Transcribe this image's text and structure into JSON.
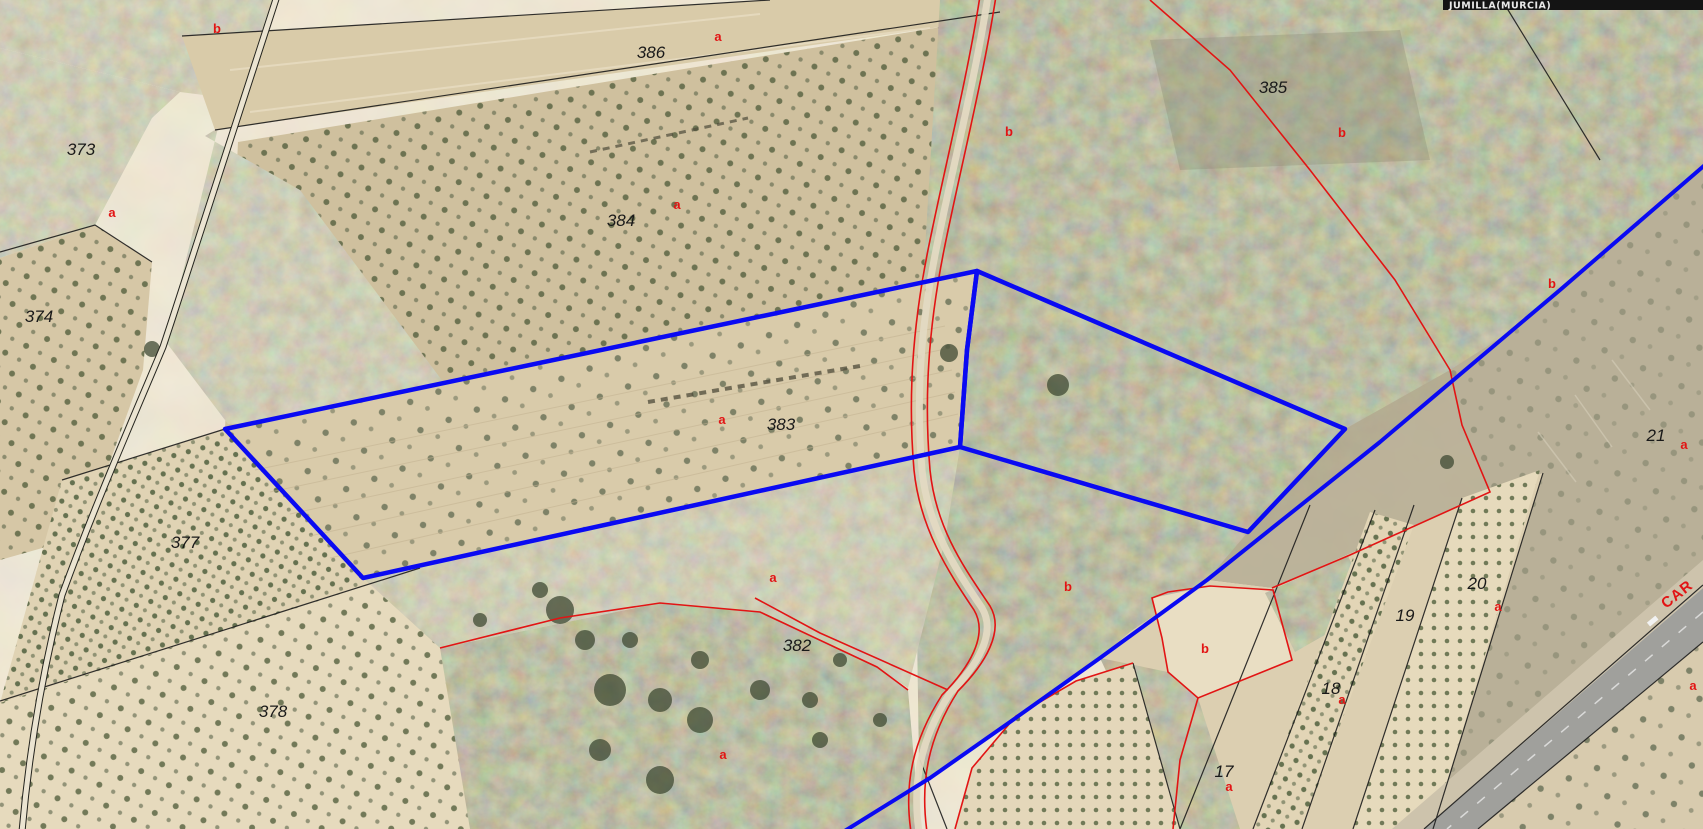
{
  "map": {
    "municipality_bar": {
      "label": "JUMILLA(MURCIA)"
    },
    "road_label": {
      "text": "CAR",
      "angle": -38
    },
    "colors": {
      "highlight_blue": "#0a0af2",
      "boundary_red": "#e21414",
      "boundary_black": "#1c1c1c",
      "bar_background": "#141414",
      "bar_text": "#e8e8e8"
    },
    "parcel_numbers": [
      {
        "text": "373",
        "x": 81,
        "y": 155
      },
      {
        "text": "374",
        "x": 39,
        "y": 322
      },
      {
        "text": "377",
        "x": 185,
        "y": 548
      },
      {
        "text": "378",
        "x": 273,
        "y": 717
      },
      {
        "text": "386",
        "x": 651,
        "y": 58
      },
      {
        "text": "384",
        "x": 621,
        "y": 226
      },
      {
        "text": "383",
        "x": 781,
        "y": 430
      },
      {
        "text": "382",
        "x": 797,
        "y": 651
      },
      {
        "text": "385",
        "x": 1273,
        "y": 93
      },
      {
        "text": "21",
        "x": 1656,
        "y": 441
      },
      {
        "text": "20",
        "x": 1477,
        "y": 589
      },
      {
        "text": "19",
        "x": 1405,
        "y": 621
      },
      {
        "text": "18",
        "x": 1331,
        "y": 694
      },
      {
        "text": "17",
        "x": 1224,
        "y": 777
      }
    ],
    "subparcel_letters": [
      {
        "text": "b",
        "x": 217,
        "y": 33
      },
      {
        "text": "a",
        "x": 112,
        "y": 217
      },
      {
        "text": "a",
        "x": 718,
        "y": 41
      },
      {
        "text": "a",
        "x": 677,
        "y": 209
      },
      {
        "text": "a",
        "x": 722,
        "y": 424
      },
      {
        "text": "b",
        "x": 1009,
        "y": 136
      },
      {
        "text": "b",
        "x": 1342,
        "y": 137
      },
      {
        "text": "b",
        "x": 1552,
        "y": 288
      },
      {
        "text": "a",
        "x": 1684,
        "y": 449
      },
      {
        "text": "a",
        "x": 1498,
        "y": 611
      },
      {
        "text": "b",
        "x": 1068,
        "y": 591
      },
      {
        "text": "b",
        "x": 1205,
        "y": 653
      },
      {
        "text": "a",
        "x": 1342,
        "y": 704
      },
      {
        "text": "a",
        "x": 1693,
        "y": 690
      },
      {
        "text": "a",
        "x": 1229,
        "y": 791
      },
      {
        "text": "a",
        "x": 723,
        "y": 759
      },
      {
        "text": "a",
        "x": 773,
        "y": 582
      }
    ]
  }
}
